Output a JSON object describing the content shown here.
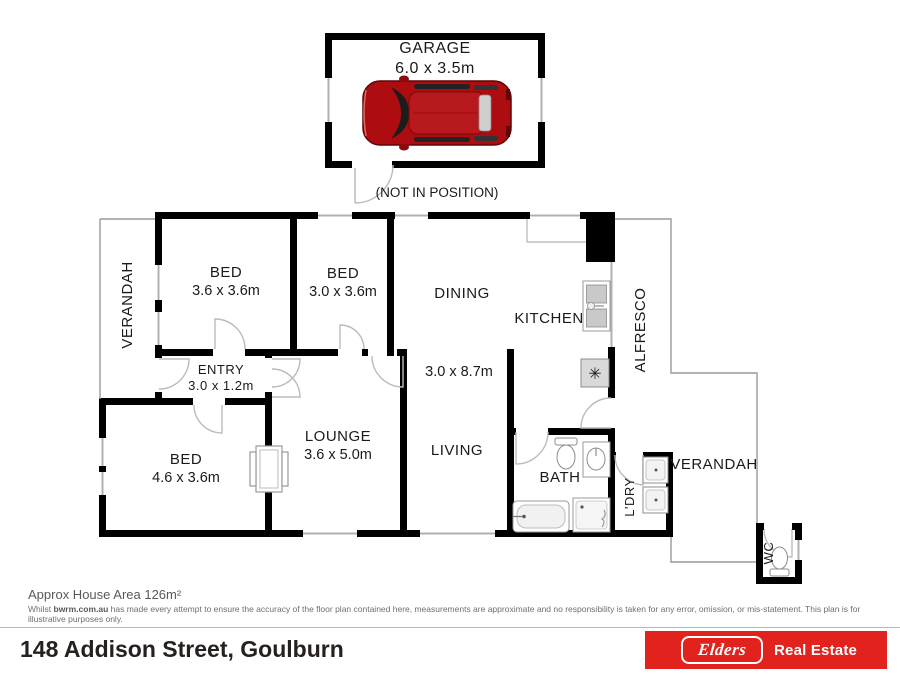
{
  "plan": {
    "garage": {
      "label": "GARAGE",
      "dims": "6.0 x 3.5m",
      "note": "(NOT IN POSITION)"
    },
    "rooms": {
      "verandah_left": {
        "label": "VERANDAH"
      },
      "bed1": {
        "label": "BED",
        "dims": "3.6 x 3.6m"
      },
      "bed2": {
        "label": "BED",
        "dims": "3.0 x 3.6m"
      },
      "dining": {
        "label": "DINING"
      },
      "kitchen": {
        "label": "KITCHEN"
      },
      "alfresco": {
        "label": "ALFRESCO"
      },
      "entry": {
        "label": "ENTRY",
        "dims": "3.0 x 1.2m"
      },
      "living_dining_dims": "3.0 x 8.7m",
      "bed3": {
        "label": "BED",
        "dims": "4.6 x 3.6m"
      },
      "lounge": {
        "label": "LOUNGE",
        "dims": "3.6 x 5.0m"
      },
      "living": {
        "label": "LIVING"
      },
      "bath": {
        "label": "BATH"
      },
      "laundry": {
        "label": "L'DRY"
      },
      "verandah_right": {
        "label": "VERANDAH"
      },
      "wc": {
        "label": "WC"
      }
    }
  },
  "notes": {
    "area": "Approx House Area 126m²",
    "disclaimer_prefix": "Whilst ",
    "disclaimer_brand": "bwrm.com.au",
    "disclaimer_rest": " has made every attempt to ensure the accuracy of the floor plan contained here, measurements are approximate and no responsibility is taken for any error, omission, or mis-statement. This plan is for illustrative purposes only."
  },
  "footer": {
    "address": "148 Addison Street, Goulburn",
    "brand_script": "Elders",
    "brand_suffix": "Real Estate"
  },
  "colors": {
    "wall": "#000000",
    "brand_red": "#e2231d",
    "line_gray": "#b0b0b0",
    "text_dark": "#1a1a1a"
  }
}
